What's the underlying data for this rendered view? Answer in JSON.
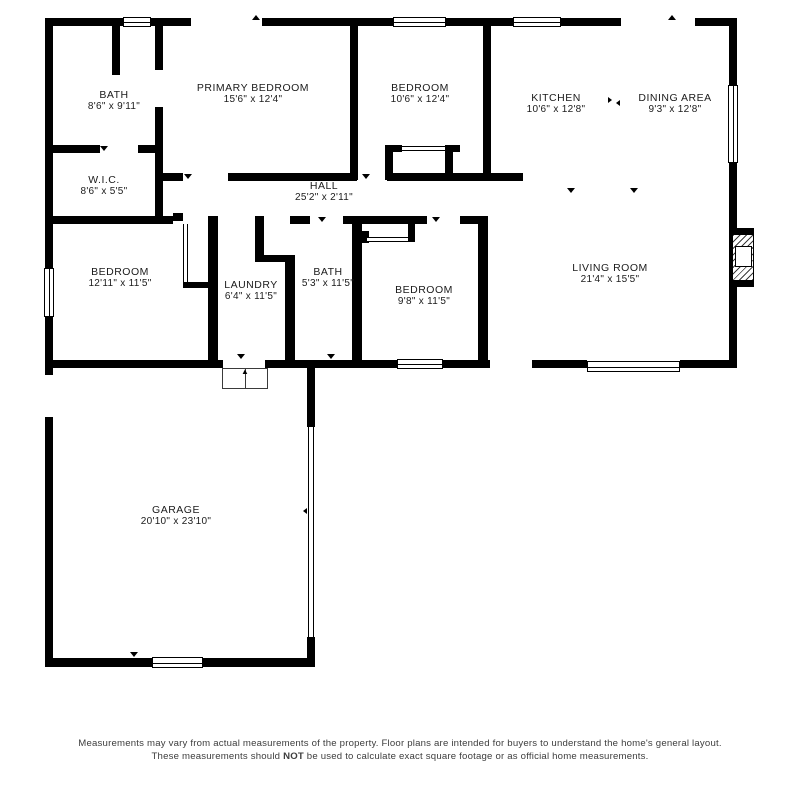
{
  "rooms": [
    {
      "id": "bath-upper",
      "name": "BATH",
      "dims": "8'6\" x 9'11\""
    },
    {
      "id": "primary",
      "name": "PRIMARY BEDROOM",
      "dims": "15'6\" x 12'4\""
    },
    {
      "id": "bedroom-top",
      "name": "BEDROOM",
      "dims": "10'6\" x 12'4\""
    },
    {
      "id": "kitchen",
      "name": "KITCHEN",
      "dims": "10'6\" x 12'8\""
    },
    {
      "id": "dining",
      "name": "DINING AREA",
      "dims": "9'3\" x 12'8\""
    },
    {
      "id": "wic",
      "name": "W.I.C.",
      "dims": "8'6\" x 5'5\""
    },
    {
      "id": "hall",
      "name": "HALL",
      "dims": "25'2\" x 2'11\""
    },
    {
      "id": "bedroom-left",
      "name": "BEDROOM",
      "dims": "12'11\" x 11'5\""
    },
    {
      "id": "laundry",
      "name": "LAUNDRY",
      "dims": "6'4\" x 11'5\""
    },
    {
      "id": "bath-lower",
      "name": "BATH",
      "dims": "5'3\" x 11'5\""
    },
    {
      "id": "bedroom-lower",
      "name": "BEDROOM",
      "dims": "9'8\" x 11'5\""
    },
    {
      "id": "living",
      "name": "LIVING ROOM",
      "dims": "21'4\" x 15'5\""
    },
    {
      "id": "garage",
      "name": "GARAGE",
      "dims": "20'10\" x 23'10\""
    }
  ],
  "steps": {
    "arrow": "▲"
  },
  "footer": {
    "text_before": "Measurements may vary from actual measurements of the property. Floor plans are intended for buyers to understand the home's general layout. These measurements should ",
    "not_label": "NOT",
    "text_after": " be used to calculate exact square footage or as official home measurements."
  },
  "colors": {
    "wall": "#000000",
    "background": "#ffffff",
    "text": "#1b1b1b"
  }
}
